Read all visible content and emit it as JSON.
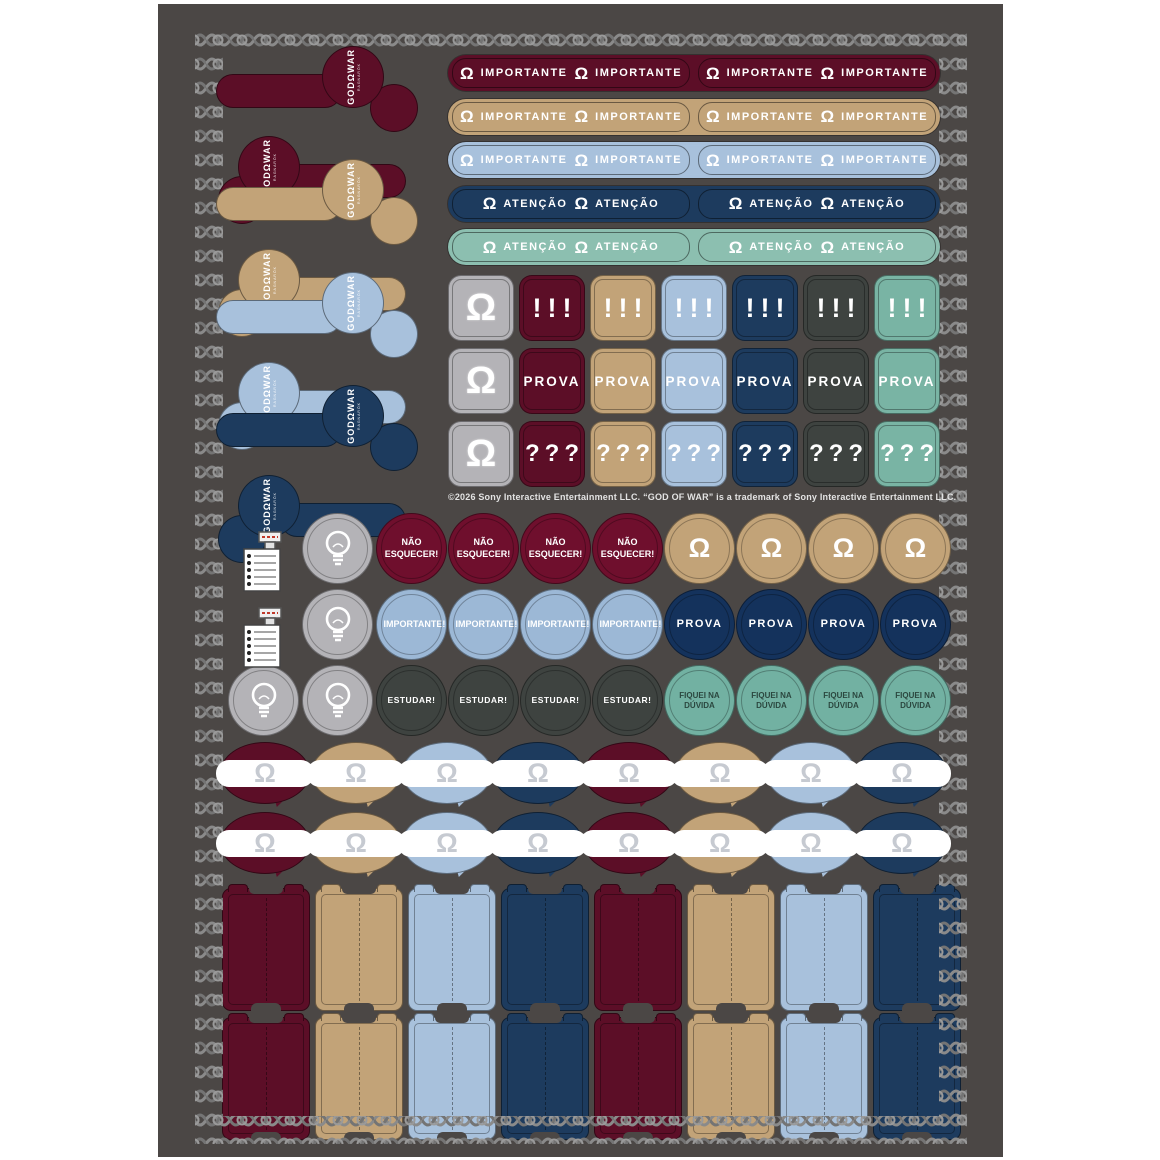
{
  "palette": {
    "page_bg": "#ffffff",
    "sheet_bg": "#4b4745",
    "knot_gray": "#8a8a8a",
    "knot_dark": "#747474",
    "maroon": "#5c0e27",
    "maroon_bright": "#6f0f2d",
    "tan": "#c2a378",
    "light_blue": "#a8c1dc",
    "light_blue_circle": "#9cb8d6",
    "dark_blue": "#1d3b5e",
    "dark_blue_deep": "#14325c",
    "teal": "#8cbfb0",
    "teal_square": "#79b4a4",
    "teal_circle": "#72b1a2",
    "slate": "#3e4340",
    "chip_gray": "#b4b3b7",
    "band_omega": "#c6cad1",
    "teal_text": "#2b473f",
    "white": "#ffffff"
  },
  "brand": {
    "logo": "GODΩWAR",
    "sub": "RAGNARÖK",
    "omega": "Ω"
  },
  "bookmarks": {
    "colors": [
      "maroon",
      "tan",
      "light_blue",
      "dark_blue"
    ],
    "per_color": 2
  },
  "label_strips": [
    {
      "color": "maroon",
      "label": "IMPORTANTE",
      "pills": 2,
      "repeats_per_pill": 2
    },
    {
      "color": "tan",
      "label": "IMPORTANTE",
      "pills": 2,
      "repeats_per_pill": 2
    },
    {
      "color": "light_blue",
      "label": "IMPORTANTE",
      "pills": 2,
      "repeats_per_pill": 2
    },
    {
      "color": "dark_blue",
      "label": "ATENÇÃO",
      "pills": 2,
      "repeats_per_pill": 2
    },
    {
      "color": "teal",
      "label": "ATENÇÃO",
      "pills": 2,
      "repeats_per_pill": 2
    }
  ],
  "square_grid": {
    "omega_column_color": "chip_gray",
    "column_colors": [
      "maroon",
      "tan",
      "light_blue",
      "dark_blue",
      "slate",
      "teal_square"
    ],
    "rows": [
      {
        "label": "!!!"
      },
      {
        "label": "PROVA"
      },
      {
        "label": "???"
      }
    ]
  },
  "copyright": "©2026 Sony Interactive Entertainment LLC. “GOD OF WAR” is a trademark of Sony Interactive Entertainment LLC.",
  "round_stickers": {
    "rows": [
      {
        "left_icons": [
          "checklist",
          "bulb"
        ],
        "groups": [
          {
            "color": "maroon_bright",
            "label": "NÃO ESQUECER!",
            "count": 4
          },
          {
            "color": "tan",
            "label": "Ω",
            "symbol": true,
            "count": 4
          }
        ]
      },
      {
        "left_icons": [
          "checklist",
          "bulb"
        ],
        "groups": [
          {
            "color": "light_blue_circle",
            "label": "IMPORTANTE!",
            "count": 4
          },
          {
            "color": "dark_blue_deep",
            "label": "PROVA",
            "count": 4
          }
        ]
      },
      {
        "left_icons": [
          "bulb",
          "bulb"
        ],
        "groups": [
          {
            "color": "slate",
            "label": "ESTUDAR!",
            "count": 4
          },
          {
            "color": "teal_circle",
            "label": "FIQUEI NA DÚVIDA",
            "count": 4,
            "dark_text": true
          }
        ]
      }
    ]
  },
  "speech_bubbles": {
    "rows": 2,
    "per_row": 8,
    "color_cycle": [
      "maroon",
      "tan",
      "light_blue",
      "dark_blue"
    ],
    "band_symbol": "Ω"
  },
  "cover_cards": {
    "rows": 2,
    "per_row": 8,
    "color_cycle": [
      "maroon",
      "tan",
      "light_blue",
      "dark_blue"
    ]
  }
}
